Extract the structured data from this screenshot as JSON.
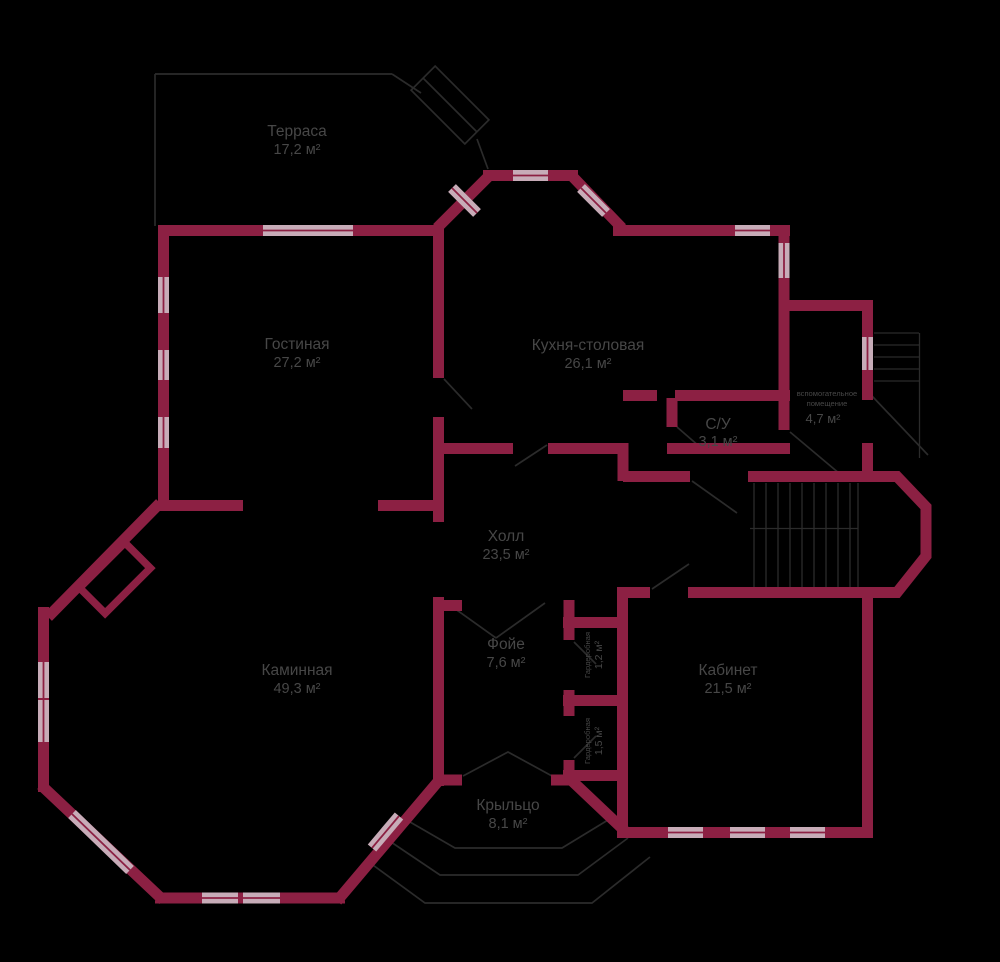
{
  "colors": {
    "wall": "#8c2043",
    "window": "#c7acb8",
    "outline": "#2b2b2b",
    "text": "#474747",
    "bg": "#000000"
  },
  "rooms": [
    {
      "name": "Терраса",
      "area": "17,2 м²"
    },
    {
      "name": "Гостиная",
      "area": "27,2 м²"
    },
    {
      "name": "Кухня-столовая",
      "area": "26,1 м²"
    },
    {
      "name": "С/У",
      "area": "3,1 м²"
    },
    {
      "name_line1": "вспомогательное",
      "name_line2": "помещение",
      "area": "4,7 м²"
    },
    {
      "name": "Холл",
      "area": "23,5 м²"
    },
    {
      "name": "Каминная",
      "area": "49,3 м²"
    },
    {
      "name": "Фойе",
      "area": "7,6 м²"
    },
    {
      "name": "Гардеробная",
      "area": "1,2 м²"
    },
    {
      "name": "Гардеробная",
      "area": "1,5 м²"
    },
    {
      "name": "Кабинет",
      "area": "21,5 м²"
    },
    {
      "name": "Крыльцо",
      "area": "8,1 м²"
    }
  ]
}
